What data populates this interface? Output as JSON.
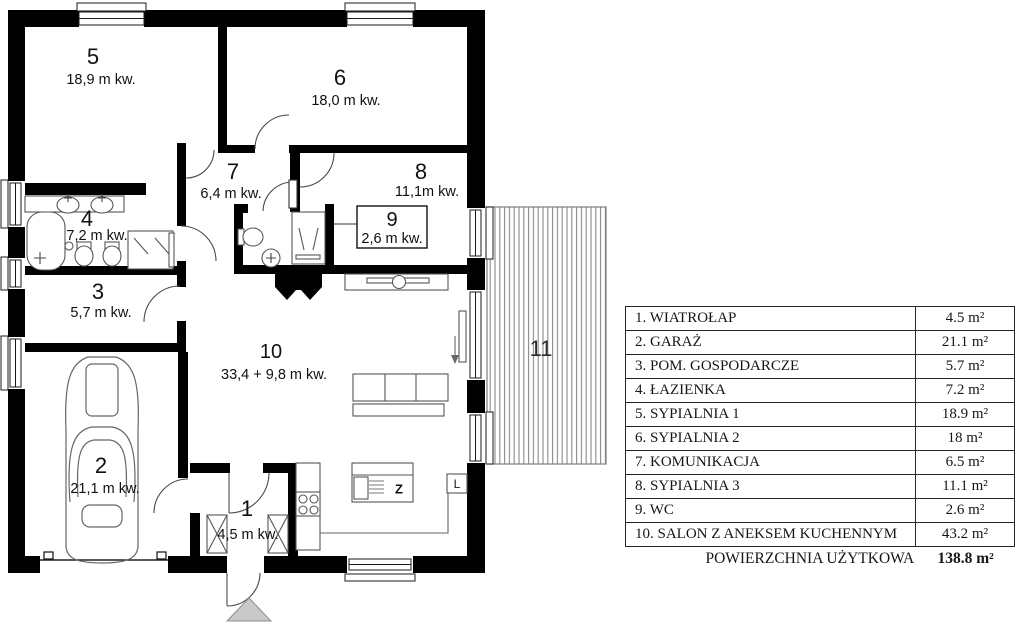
{
  "plan": {
    "room_labels": [
      {
        "num": "5",
        "area": "18,9 m kw."
      },
      {
        "num": "6",
        "area": "18,0 m kw."
      },
      {
        "num": "7",
        "area": "6,4 m kw."
      },
      {
        "num": "8",
        "area": "11,1m kw."
      },
      {
        "num": "9",
        "area": "2,6 m kw."
      },
      {
        "num": "4",
        "area": "7,2 m kw."
      },
      {
        "num": "3",
        "area": "5,7 m kw."
      },
      {
        "num": "2",
        "area": "21,1 m kw."
      },
      {
        "num": "10",
        "area": "33,4 + 9,8 m kw."
      },
      {
        "num": "1",
        "area": "4,5 m kw."
      },
      {
        "num": "11",
        "area": ""
      }
    ],
    "kitchen": {
      "sink_label": "Z",
      "fridge_label": "L"
    },
    "colors": {
      "wall": "#000000",
      "terrace_stripe": "#8a8a8a",
      "entrance_arrow": "#c9c9c9"
    }
  },
  "legend": {
    "rows": [
      {
        "name": "1. WIATROŁAP",
        "area": "4.5 m²"
      },
      {
        "name": "2. GARAŻ",
        "area": "21.1 m²"
      },
      {
        "name": "3. POM. GOSPODARCZE",
        "area": "5.7 m²"
      },
      {
        "name": "4. ŁAZIENKA",
        "area": "7.2 m²"
      },
      {
        "name": "5. SYPIALNIA 1",
        "area": "18.9 m²"
      },
      {
        "name": "6. SYPIALNIA 2",
        "area": "18 m²"
      },
      {
        "name": "7. KOMUNIKACJA",
        "area": "6.5 m²"
      },
      {
        "name": "8. SYPIALNIA 3",
        "area": "11.1 m²"
      },
      {
        "name": "9. WC",
        "area": "2.6 m²"
      },
      {
        "name": "10. SALON Z ANEKSEM KUCHENNYM",
        "area": "43.2 m²"
      }
    ],
    "footer_label": "POWIERZCHNIA UŻYTKOWA",
    "footer_value": "138.8 m²"
  }
}
